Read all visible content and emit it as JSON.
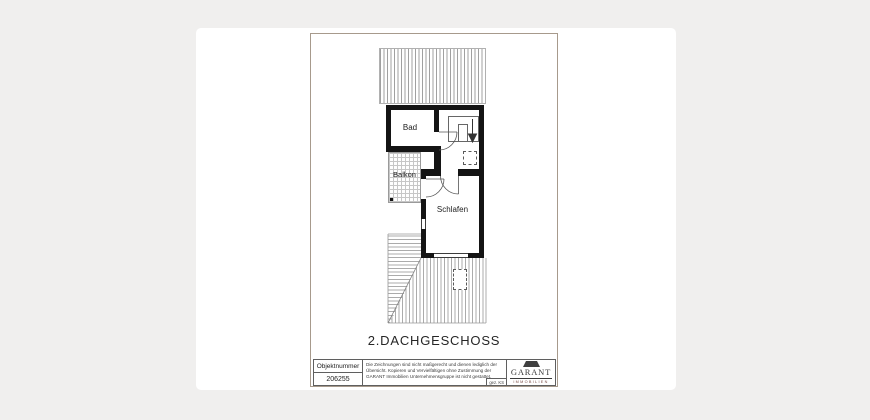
{
  "floor_plan": {
    "title": "2.DACHGESCHOSS",
    "rooms": [
      {
        "name": "Bad"
      },
      {
        "name": "Balkon"
      },
      {
        "name": "Schlafen"
      }
    ]
  },
  "title_block": {
    "object_number_label": "Objektnummer",
    "object_number": "206255",
    "disclaimer": "Die Zeichnungen sind nicht maßgerecht und dienen lediglich der Übersicht. Kopieren und Vervielfältigen ohne Zustimmung der GARANT Immobilien Unternehmensgruppe ist nicht gestattet.",
    "drawn_by": "gez. KS",
    "logo": {
      "name": "GARANT",
      "subtitle": "IMMOBILIEN"
    }
  },
  "colors": {
    "background": "#f0efee",
    "wall": "#141414",
    "hatch_line": "#a0a0a0",
    "sheet_border": "#a79a8c",
    "logo_text": "#3a3a3a"
  }
}
